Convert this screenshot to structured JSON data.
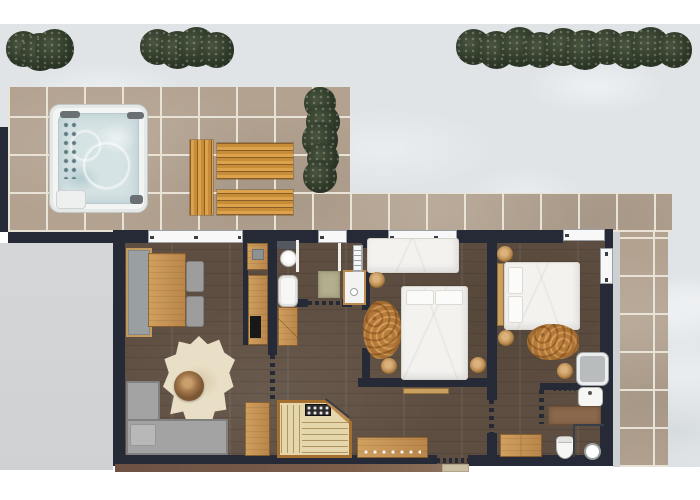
{
  "title": "Chalet apartment floor plan with snowy terrace, hot tub, sauna and two bedrooms",
  "palette": {
    "snow": "#e0e4e7",
    "terrace_tile": "#b3a290",
    "tile_grout": "#e9e2d7",
    "deck_wood": "#d9a04b",
    "bush_green": "#2e3928",
    "wall": "#262a37",
    "interior_floor": "#5e4e41",
    "furniture_wood": "#c08b4e",
    "sofa_gray": "#a3a3a3",
    "bed_white": "#f3f2ef",
    "hot_tub_water": "#d6e3e5",
    "fluffy_rug": "#b67c3c",
    "cowhide_rug": "#e9dfc6",
    "driveway": "#d3d5d7",
    "sauna_bench": "#e6d6ab"
  },
  "rooms": {
    "terrace": "Tiled terrace",
    "hot_tub": "Hot tub",
    "deck": "Wooden deck",
    "hedge": "Hedges",
    "driveway": "Driveway",
    "living": "Living room",
    "kitchen": "Kitchenette",
    "bath1": "Bathroom",
    "hall": "Hallway",
    "sauna": "Sauna",
    "bed1": "Bedroom 1",
    "bed2": "Bedroom 2",
    "bath2": "Shower room",
    "entry": "Entrance"
  },
  "furniture": {
    "sofa": "Corner sofa",
    "dining_table": "Dining table",
    "dining_bench": "Bench",
    "chairs": "Chairs",
    "pouf": "Pouf",
    "cowhide": "Cowhide rug",
    "kitchen_counter": "Kitchen counter",
    "cooktop": "Cooktop",
    "bathtub": "Bathtub",
    "shower": "Shower",
    "washbasin": "Washbasin",
    "towel_radiator": "Towel radiator",
    "wardrobe": "Wardrobe",
    "sideboard": "Sideboard",
    "single_bed": "Single bed",
    "double_bed": "Double bed",
    "sheepskin": "Sheepskin rug",
    "stool": "Wooden stool",
    "armchair": "Armchair",
    "toilet": "Toilet",
    "vanity": "Vanity cabinet",
    "sauna_heater": "Sauna heater",
    "entrance_mat": "Entrance mat"
  },
  "bushes": [
    {
      "x": 6,
      "y": 30,
      "w": 68,
      "h": 40,
      "dir": "h"
    },
    {
      "x": 140,
      "y": 28,
      "w": 94,
      "h": 40,
      "dir": "h"
    },
    {
      "x": 456,
      "y": 28,
      "w": 236,
      "h": 40,
      "dir": "h"
    },
    {
      "x": 303,
      "y": 87,
      "w": 36,
      "h": 106,
      "dir": "v"
    }
  ],
  "stools": [
    [
      369,
      272
    ],
    [
      381,
      358
    ],
    [
      470,
      357
    ],
    [
      497,
      246
    ],
    [
      498,
      330
    ],
    [
      557,
      363
    ]
  ]
}
